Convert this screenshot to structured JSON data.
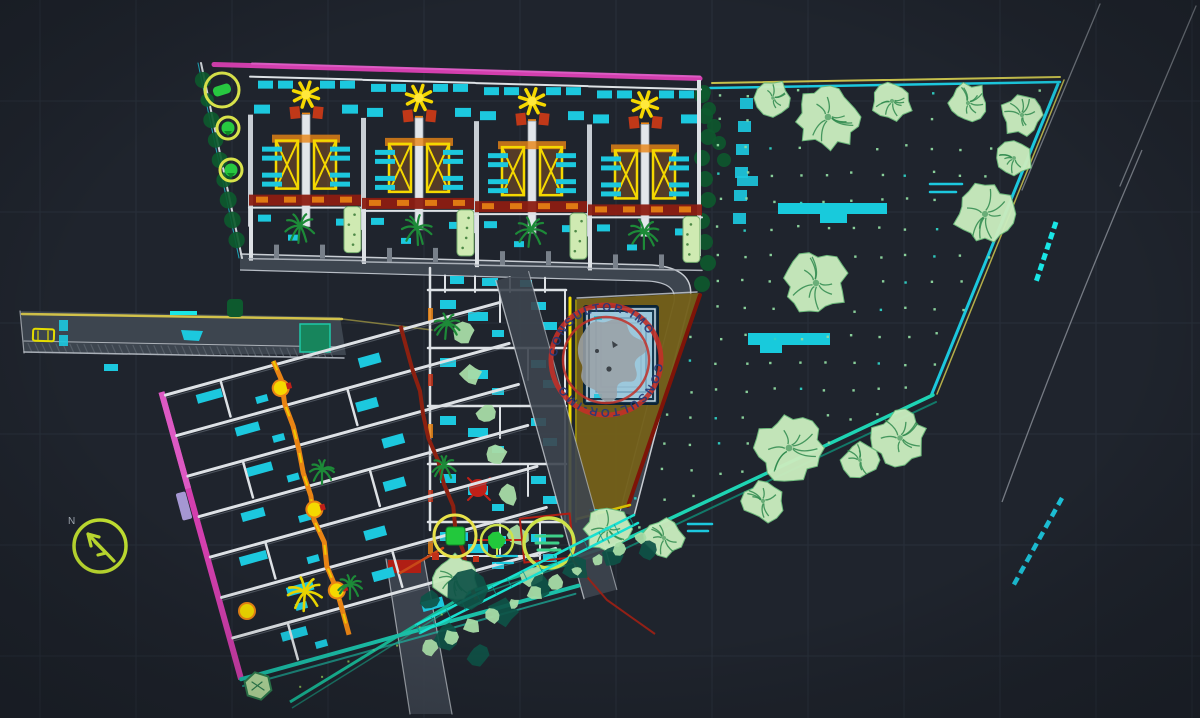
{
  "scene": {
    "width": 1200,
    "height": 718,
    "background": "#1f242d",
    "description": "CAD site plan drawing - residential development with housing blocks, pool deck and landscaped garden",
    "grid": {
      "color": "#2a313c",
      "offset_x": 40,
      "spacing_x": 96,
      "offset_y": 101,
      "spacing_y": 111
    }
  },
  "palette": {
    "cyan": "#1cc8de",
    "cyan_bright": "#19e6e6",
    "teal": "#1ec9a8",
    "teal_line": "#18b896",
    "teal_dark": "#0e5246",
    "magenta": "#d33fae",
    "pink": "#e060c8",
    "yellow": "#f5d800",
    "yellow_green": "#c6e632",
    "orange": "#e98414",
    "red": "#c0281c",
    "dark_red": "#7e1408",
    "red_band": "#8c1e12",
    "white_wall": "#dde1e5",
    "gray_wall": "#8a929c",
    "road_fill": "#3d454f",
    "road_edge": "#c9ced4",
    "tree_light": "#c9ecbe",
    "tree_edge": "#6fbf7e",
    "tree_detail": "#2f8a4d",
    "palm_green": "#1d8a38",
    "hedge_dark": "#0d5a2e",
    "shrub_light": "#a8dca6",
    "olive": "#74601a",
    "olive_edge": "#d8c000",
    "pool_water": "#9cc8dc",
    "pool_frame": "#16384e",
    "pool_inner_line": "#6898b4",
    "lavender": "#b4a4e4",
    "dot_green": "#8fd9a0",
    "dot_cyan": "#2fd0c4",
    "grid_line": "#2a313c"
  },
  "stamp": {
    "ring_text": "CONSULTOR-IMO",
    "ring_color": "#c23028",
    "text_color": "#263a78",
    "center_x": 606,
    "center_y": 360,
    "outer_radius": 55,
    "inner_radius": 43
  },
  "north_arrow": {
    "label": "N",
    "center_x": 100,
    "center_y": 546,
    "radius": 26,
    "color": "#c6e632"
  },
  "garden": {
    "dot_spacing": 27,
    "boundary": [
      [
        710,
        90
      ],
      [
        1058,
        84
      ],
      [
        932,
        394
      ],
      [
        618,
        542
      ],
      [
        655,
        420
      ],
      [
        695,
        300
      ],
      [
        706,
        150
      ]
    ],
    "tree_crowns": [
      [
        773,
        98,
        18
      ],
      [
        828,
        117,
        33
      ],
      [
        892,
        101,
        21
      ],
      [
        968,
        103,
        21
      ],
      [
        1022,
        115,
        22
      ],
      [
        1014,
        158,
        19
      ],
      [
        985,
        214,
        31
      ],
      [
        816,
        283,
        32
      ],
      [
        789,
        448,
        34
      ],
      [
        860,
        460,
        19
      ],
      [
        900,
        438,
        28
      ],
      [
        763,
        501,
        21
      ],
      [
        664,
        538,
        20
      ],
      [
        607,
        529,
        24
      ],
      [
        455,
        578,
        24
      ]
    ]
  },
  "planting": {
    "palms_dark": [
      [
        300,
        226,
        15
      ],
      [
        417,
        228,
        15
      ],
      [
        531,
        230,
        15
      ],
      [
        644,
        232,
        15
      ],
      [
        447,
        324,
        13
      ],
      [
        444,
        466,
        12
      ],
      [
        322,
        470,
        12
      ],
      [
        350,
        585,
        12
      ]
    ],
    "palm_yellow": [
      305,
      592,
      17
    ]
  },
  "upper_block": {
    "unit_centers": [
      306,
      419,
      532,
      645
    ],
    "tree_circles": [
      [
        222,
        90,
        17
      ],
      [
        228,
        128,
        11
      ],
      [
        231,
        170,
        11
      ]
    ]
  },
  "lower_block": {
    "rows": 7,
    "origin": [
      162,
      394
    ],
    "rotation_deg": -15.5
  },
  "center_block": {
    "row_ys": [
      290,
      348,
      406,
      464,
      522
    ]
  },
  "planters": {
    "circle_square": [
      455,
      536,
      21
    ],
    "circle_blob": [
      497,
      541,
      16
    ],
    "circle_lines": [
      549,
      543,
      25
    ]
  }
}
